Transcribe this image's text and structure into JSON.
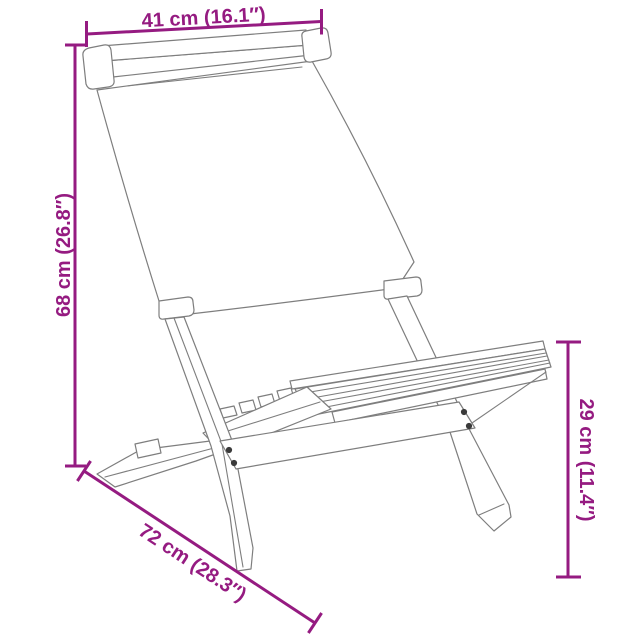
{
  "colors": {
    "dimension_accent": "#951B81",
    "drawing_line": "#7E7E7E",
    "screw_dot": "#3A3A3A",
    "background": "#FFFFFF"
  },
  "dimensions": {
    "top_width": {
      "label": "41 cm (16.1″)"
    },
    "left_height": {
      "label": "68 cm (26.8″)"
    },
    "right_seat_height": {
      "label": "29 cm (11.4″)"
    },
    "bottom_depth": {
      "label": "72 cm (28.3″)"
    }
  },
  "drawing": {
    "subject": "folding-chair-line-drawing"
  }
}
